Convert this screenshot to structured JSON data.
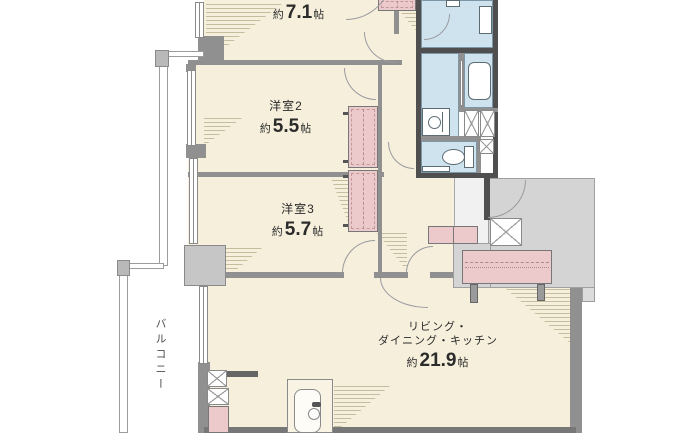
{
  "rooms": {
    "bedroom1": {
      "name": "洋室1",
      "area_prefix": "約",
      "area": "7.1",
      "area_unit": "帖"
    },
    "bedroom2": {
      "name": "洋室2",
      "area_prefix": "約",
      "area": "5.5",
      "area_unit": "帖"
    },
    "bedroom3": {
      "name": "洋室3",
      "area_prefix": "約",
      "area": "5.7",
      "area_unit": "帖"
    },
    "ldk": {
      "name_line1": "リビング・",
      "name_line2": "ダイニング・キッチン",
      "area_prefix": "約",
      "area": "21.9",
      "area_unit": "帖"
    },
    "balcony": {
      "name": "バルコニー"
    }
  },
  "colors": {
    "floor_cream": "#f5efdb",
    "wet_area_blue": "#cfe3ee",
    "furniture_pink": "#ecc9cb",
    "wall_gray": "#909090",
    "wall_dark": "#4f4f4f",
    "common_area_gray": "#d4d4d4",
    "hatch_line": "#9e946a",
    "text": "#2b2b2b"
  }
}
